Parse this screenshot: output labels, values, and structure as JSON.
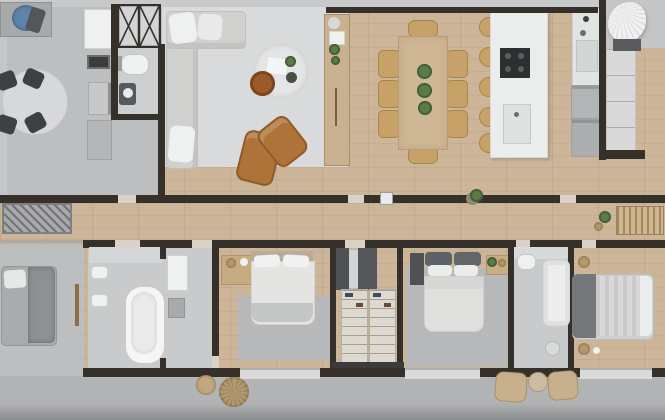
{
  "scene": {
    "kind": "3d-rendered-floor-plan",
    "view": "top-down",
    "rooms": [
      "utility-area",
      "powder-bathroom",
      "service-shaft",
      "living-room",
      "dining-area",
      "kitchen-island",
      "kitchen-run",
      "pantry-corner",
      "hallway",
      "lounge-room",
      "main-bathroom",
      "bedroom-1",
      "walk-in-closet",
      "bedroom-2",
      "ensuite-bathroom",
      "bedroom-3",
      "terrace"
    ],
    "furniture": [
      "round-breakfast-table",
      "black-dining-chairs",
      "utility-counter-with-blue-dishes",
      "white-storage-cabinet",
      "x-braced-shaft",
      "toilet",
      "wall-sink",
      "kitchenette-fridge",
      "kitchenette-oven",
      "l-shaped-sofa",
      "white-throw-pillows",
      "round-coffee-table",
      "copper-side-table",
      "cognac-armchair-pair",
      "wood-console-with-plants",
      "dining-table-8-chairs",
      "potted-plants-trio",
      "kitchen-island-5-stools",
      "induction-cooktop",
      "island-sink",
      "counter-sink",
      "fridge-appliance-boxes",
      "tall-cabinet-column",
      "fan-decor",
      "entry-doormat",
      "hallway-bench",
      "hallway-plant",
      "switch-panel",
      "gray-daybed",
      "freestanding-bathtub",
      "double-wall-sinks",
      "shower-fixture",
      "bedroom1-bed",
      "bedroom1-dresser",
      "bedroom1-rug",
      "closet-shelving-units",
      "dark-wardrobes",
      "bedroom2-bed",
      "bedroom2-nightstands",
      "bedroom2-rug",
      "ensuite-toilet",
      "ensuite-shower",
      "drain-mat",
      "bedroom3-bed",
      "woven-decor-balls",
      "terrace-chairs",
      "terrace-side-table"
    ]
  },
  "colors": {
    "wood": "#ccb598",
    "wall": "#36302a",
    "doorGap": "#d8d2c7",
    "grayFloor": "#bdbec0",
    "bathFloor": "#c9cacb",
    "terrace": "#b2b3b5",
    "terraceEdge": "#8b8c8e",
    "rug": "#d9dadb",
    "rugGray": "#b7b8b9",
    "white": "#eff0f0",
    "softWhite": "#e3e4e3",
    "sofa": "#d0d1cf",
    "cognac": "#ad7339",
    "cognacDark": "#8f5c28",
    "tan": "#c6a168",
    "tanDark": "#a98648",
    "wovenTan": "#b89a6e",
    "tableWood": "#cfb795",
    "consoleWood": "#c9b08e",
    "green": "#5d7b47",
    "greenDark": "#44603a",
    "dark": "#3e4043",
    "appliance": "#b3b4b5",
    "steel": "#9fa0a1",
    "island": "#ebedec",
    "cooktop": "#2e2f31",
    "blue": "#5e84a8",
    "bed": "#e4e4e3",
    "bedGray": "#d2d3d3",
    "pillowDark": "#5e6267",
    "headboard": "#74777a",
    "shelfCream": "#ded9d0",
    "plinth": "#3c3b39",
    "copper": "#9c5a2a",
    "benchTan": "#cfb590",
    "matGray": "#a8a9aa"
  }
}
